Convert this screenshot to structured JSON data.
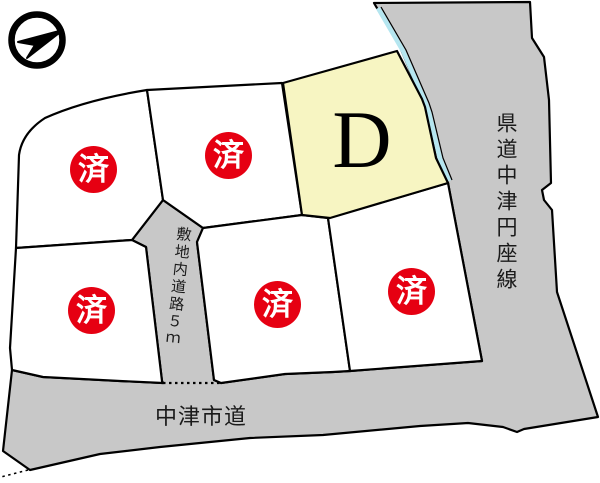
{
  "compass": {
    "name": "north-arrow"
  },
  "parcels": [
    {
      "name": "top-left",
      "label": "済",
      "status": "sold"
    },
    {
      "name": "top-center",
      "label": "済",
      "status": "sold"
    },
    {
      "name": "lot-d",
      "label": "D",
      "status": "available"
    },
    {
      "name": "lower-left",
      "label": "済",
      "status": "sold"
    },
    {
      "name": "lower-center",
      "label": "済",
      "status": "sold"
    },
    {
      "name": "lower-right",
      "label": "済",
      "status": "sold"
    }
  ],
  "roads": {
    "prefectural": {
      "label": "県道中津円座線"
    },
    "city": {
      "label": "中津市道"
    },
    "internal": {
      "label": "敷地内道路５ｍ"
    }
  },
  "colors": {
    "road_gray": "#c8c8c8",
    "lot_available_yellow": "#f7f5c2",
    "sold_badge_red": "#e60012",
    "edge_stripe_cyan": "#b5e6f0",
    "line_black": "#000000"
  }
}
